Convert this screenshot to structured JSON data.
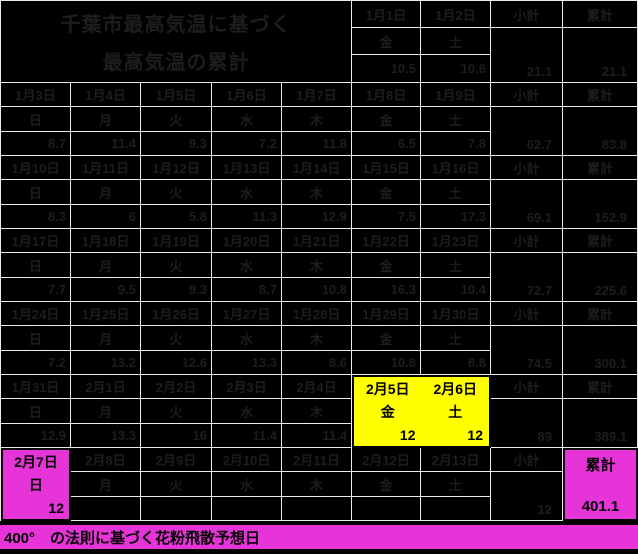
{
  "title": {
    "line1": "千葉市最高気温に基づく",
    "line2": "最高気温の累計"
  },
  "columns": {
    "subtotal": "小計",
    "cumulative": "累計"
  },
  "caption": "400°　の法則に基づく花粉飛散予想日",
  "colors": {
    "cell_background": "#000000",
    "grid_line": "#ededed",
    "faint_text": "#1d1d1d",
    "highlight_yellow": "#ffff00",
    "highlight_magenta": "#e734d8",
    "highlight_text": "#000000"
  },
  "weeks": [
    {
      "days": [
        {
          "date": "1月1日",
          "dow": "金",
          "value": "10.5"
        },
        {
          "date": "1月2日",
          "dow": "土",
          "value": "10.6"
        }
      ],
      "subtotal": "21.1",
      "cumulative": "21.1"
    },
    {
      "days": [
        {
          "date": "1月3日",
          "dow": "日",
          "value": "8.7"
        },
        {
          "date": "1月4日",
          "dow": "月",
          "value": "11.4"
        },
        {
          "date": "1月5日",
          "dow": "火",
          "value": "9.3"
        },
        {
          "date": "1月6日",
          "dow": "水",
          "value": "7.2"
        },
        {
          "date": "1月7日",
          "dow": "木",
          "value": "11.8"
        },
        {
          "date": "1月8日",
          "dow": "金",
          "value": "6.5"
        },
        {
          "date": "1月9日",
          "dow": "土",
          "value": "7.8"
        }
      ],
      "subtotal": "62.7",
      "cumulative": "83.8"
    },
    {
      "days": [
        {
          "date": "1月10日",
          "dow": "日",
          "value": "8.3"
        },
        {
          "date": "1月11日",
          "dow": "月",
          "value": "6"
        },
        {
          "date": "1月12日",
          "dow": "火",
          "value": "5.8"
        },
        {
          "date": "1月13日",
          "dow": "水",
          "value": "11.3"
        },
        {
          "date": "1月14日",
          "dow": "木",
          "value": "12.9"
        },
        {
          "date": "1月15日",
          "dow": "金",
          "value": "7.5"
        },
        {
          "date": "1月16日",
          "dow": "土",
          "value": "17.3"
        }
      ],
      "subtotal": "69.1",
      "cumulative": "152.9"
    },
    {
      "days": [
        {
          "date": "1月17日",
          "dow": "日",
          "value": "7.7"
        },
        {
          "date": "1月18日",
          "dow": "月",
          "value": "9.5"
        },
        {
          "date": "1月19日",
          "dow": "火",
          "value": "9.3"
        },
        {
          "date": "1月20日",
          "dow": "水",
          "value": "8.7"
        },
        {
          "date": "1月21日",
          "dow": "木",
          "value": "10.8"
        },
        {
          "date": "1月22日",
          "dow": "金",
          "value": "16.3"
        },
        {
          "date": "1月23日",
          "dow": "土",
          "value": "10.4"
        }
      ],
      "subtotal": "72.7",
      "cumulative": "225.6"
    },
    {
      "days": [
        {
          "date": "1月24日",
          "dow": "日",
          "value": "7.2"
        },
        {
          "date": "1月25日",
          "dow": "月",
          "value": "13.2"
        },
        {
          "date": "1月26日",
          "dow": "火",
          "value": "12.6"
        },
        {
          "date": "1月27日",
          "dow": "水",
          "value": "13.3"
        },
        {
          "date": "1月28日",
          "dow": "木",
          "value": "8.6"
        },
        {
          "date": "1月29日",
          "dow": "金",
          "value": "10.8"
        },
        {
          "date": "1月30日",
          "dow": "土",
          "value": "8.8"
        }
      ],
      "subtotal": "74.5",
      "cumulative": "300.1"
    },
    {
      "days": [
        {
          "date": "1月31日",
          "dow": "日",
          "value": "12.9"
        },
        {
          "date": "2月1日",
          "dow": "月",
          "value": "13.3"
        },
        {
          "date": "2月2日",
          "dow": "火",
          "value": "16"
        },
        {
          "date": "2月3日",
          "dow": "水",
          "value": "11.4"
        },
        {
          "date": "2月4日",
          "dow": "木",
          "value": "11.4"
        },
        {
          "date": "2月5日",
          "dow": "金",
          "value": "12",
          "highlight": "yellow"
        },
        {
          "date": "2月6日",
          "dow": "土",
          "value": "12",
          "highlight": "yellow"
        }
      ],
      "subtotal": "89",
      "cumulative": "389.1"
    },
    {
      "days": [
        {
          "date": "2月7日",
          "dow": "日",
          "value": "12",
          "highlight": "magenta"
        },
        {
          "date": "2月8日",
          "dow": "月",
          "value": ""
        },
        {
          "date": "2月9日",
          "dow": "火",
          "value": ""
        },
        {
          "date": "2月10日",
          "dow": "水",
          "value": ""
        },
        {
          "date": "2月11日",
          "dow": "木",
          "value": ""
        },
        {
          "date": "2月12日",
          "dow": "金",
          "value": ""
        },
        {
          "date": "2月13日",
          "dow": "土",
          "value": ""
        }
      ],
      "subtotal": "12",
      "cumulative": "401.1",
      "cumulative_highlight": "magenta"
    }
  ]
}
